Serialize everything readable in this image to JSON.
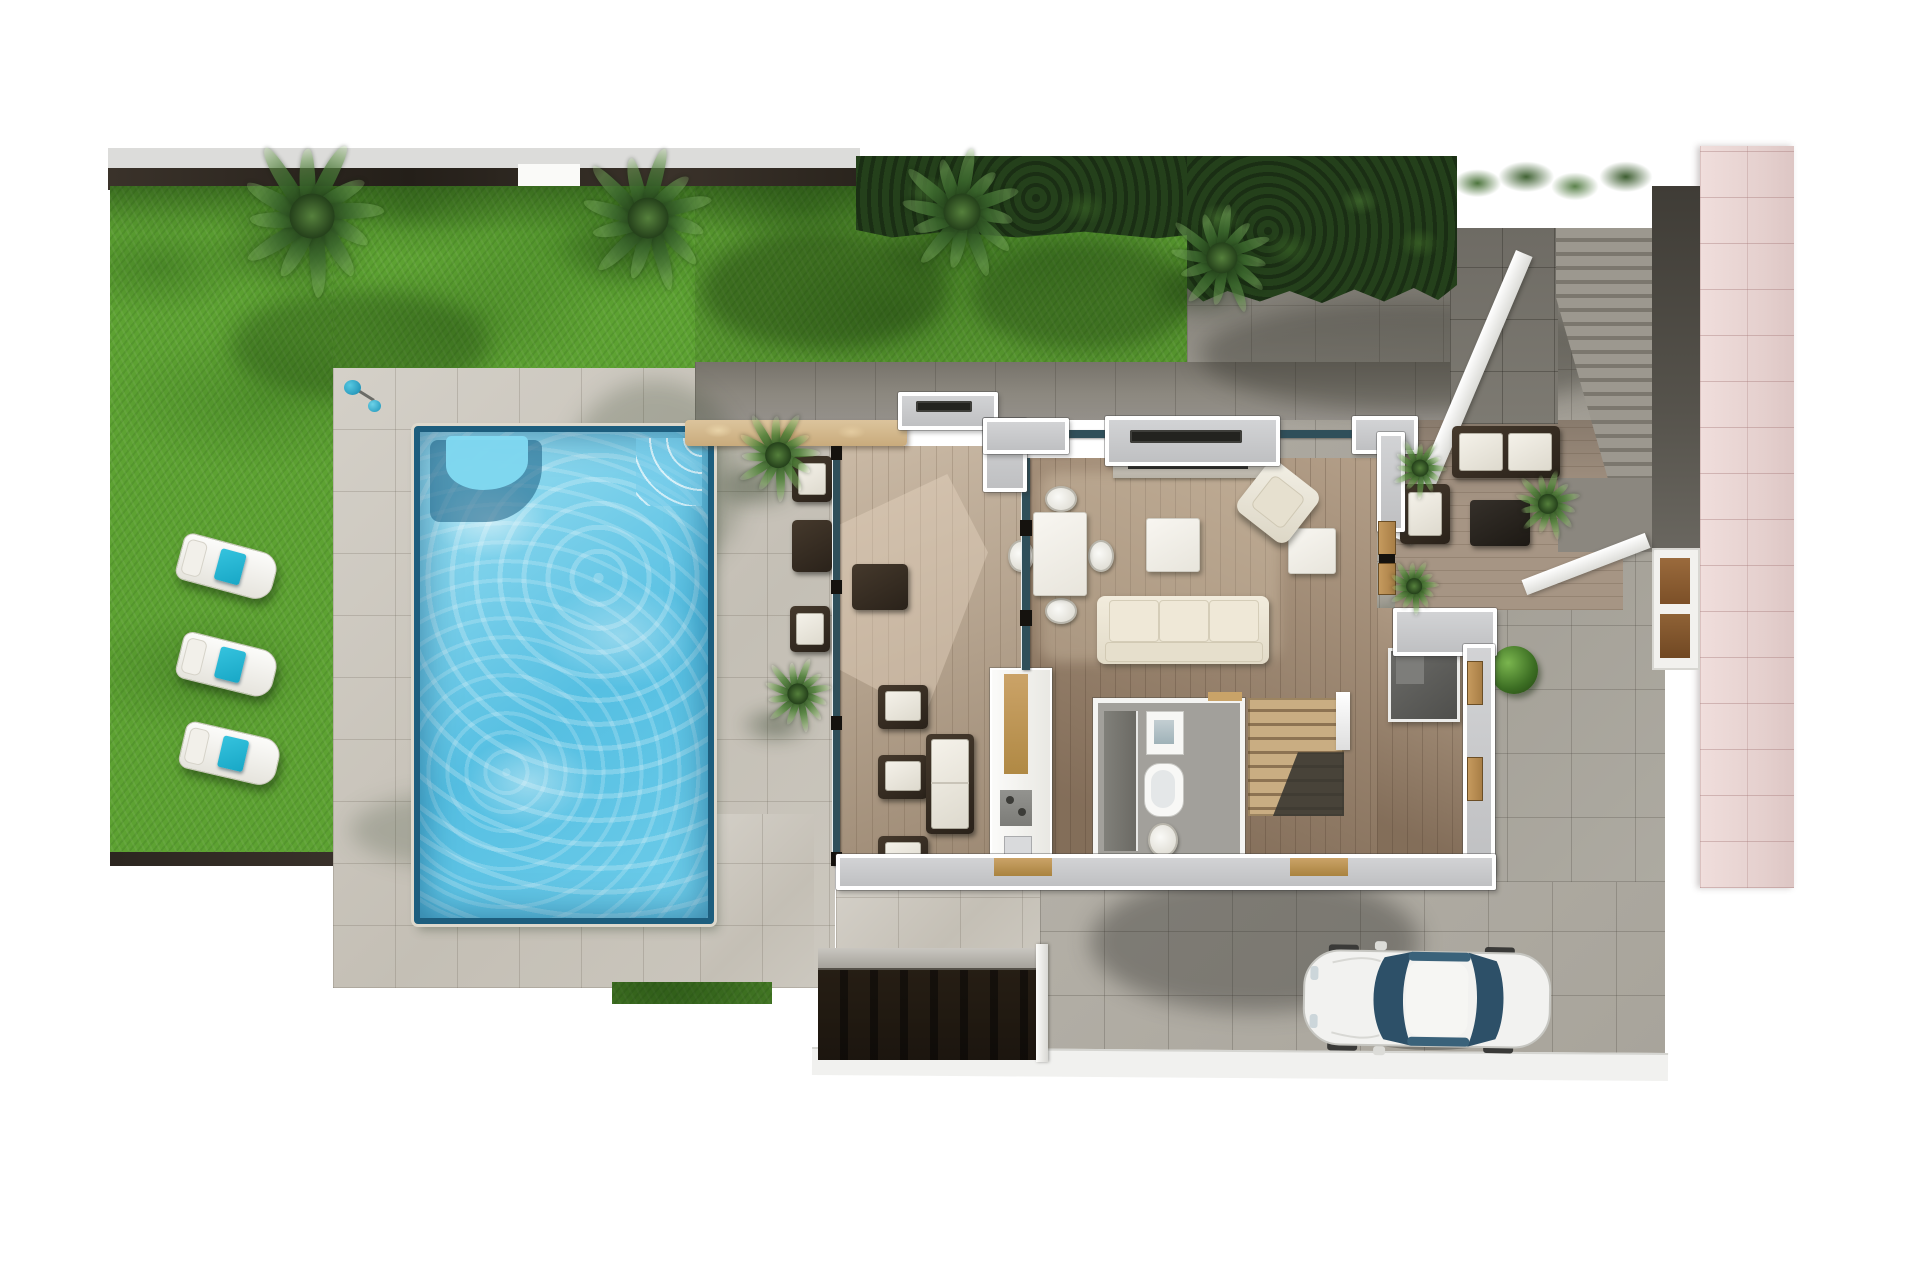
{
  "scene": {
    "title": "Villa ground-floor plan - top-down 3D render",
    "style": "photorealistic architectural visualization, no visible text"
  },
  "colors": {
    "page_bg": "#ffffff",
    "grass": "#5da232",
    "grass_shade": "#3f7d22",
    "hedge": "#24401b",
    "pool_water": "#63c8e8",
    "pool_rim": "#1d5e7e",
    "pool_bench": "#2e7da4",
    "tile_light": "#cbc6bd",
    "tile_shaded": "#8f8b82",
    "driveway": "#a8a49b",
    "deck_wood": "#b5a28c",
    "interior_wood": "#a08a73",
    "patio_wood": "#a69584",
    "wall_fill": "#c6c7c9",
    "wall_edge": "#ffffff",
    "glass": "#2f4f5a",
    "stone_bar": "#d9c29a",
    "cream_sofa": "#ece6d6",
    "dark_wicker": "#393026",
    "towel_teal": "#18a7c6",
    "sidewalk_pink": "#ead7d5",
    "ramp_dark": "#38322a",
    "stair_wood": "#c4a87e",
    "car_body": "#f2f2f0",
    "car_glass": "#2d5068",
    "bush_green": "#4e8f2e"
  },
  "rooms": {
    "lawn": {
      "label": "Garden lawn"
    },
    "pool": {
      "label": "Swimming pool"
    },
    "pool_terrace": {
      "label": "Pool terrace"
    },
    "covered_terrace": {
      "label": "Covered wooden terrace"
    },
    "living_dining": {
      "label": "Living and dining room"
    },
    "kitchen": {
      "label": "Kitchen"
    },
    "bathroom": {
      "label": "Bathroom"
    },
    "staircase": {
      "label": "Interior staircase"
    },
    "utility": {
      "label": "Utility room"
    },
    "east_patio": {
      "label": "East lounge patio"
    },
    "driveway": {
      "label": "Driveway parking"
    },
    "garage_ramp": {
      "label": "Garage ramp"
    },
    "entry_stairs": {
      "label": "External entry stairs"
    },
    "sidewalk": {
      "label": "Street sidewalk"
    },
    "street": {
      "label": "Street edge"
    }
  },
  "furniture": {
    "sun_lounger": {
      "label": "Sun lounger with towel"
    },
    "outdoor_shower": {
      "label": "Pool shower"
    },
    "stone_bar": {
      "label": "Outdoor stone bar counter"
    },
    "dining_table": {
      "label": "Dining table with four chairs"
    },
    "sofa": {
      "label": "Three-seat cream sofa"
    },
    "armchair": {
      "label": "Lounge armchair"
    },
    "coffee_table": {
      "label": "Coffee table"
    },
    "side_table": {
      "label": "Side table"
    },
    "tv_wall": {
      "label": "North window and TV wall"
    },
    "kitchen_counter": {
      "label": "Kitchen counter with sink"
    },
    "bathtub": {
      "label": "Bathtub"
    },
    "washbasin": {
      "label": "Washbasin"
    },
    "wc": {
      "label": "WC"
    },
    "utility_box": {
      "label": "Utility / shower box"
    },
    "patio_sofa": {
      "label": "Outdoor lounge sofa"
    },
    "patio_table": {
      "label": "Outdoor coffee table"
    },
    "patio_chair": {
      "label": "Outdoor armchair"
    },
    "fire_table": {
      "label": "Fire table"
    },
    "daybed": {
      "label": "Deck daybed"
    },
    "car": {
      "label": "White car parked on driveway"
    }
  },
  "landscape": {
    "palm_trees": [
      {
        "x": 312,
        "y": 216,
        "r": 80,
        "tone": 1
      },
      {
        "x": 648,
        "y": 218,
        "r": 73,
        "tone": 1
      },
      {
        "x": 962,
        "y": 212,
        "r": 66,
        "tone": 1
      },
      {
        "x": 1222,
        "y": 258,
        "r": 56,
        "tone": 1
      },
      {
        "x": 778,
        "y": 455,
        "r": 46,
        "tone": 2
      },
      {
        "x": 798,
        "y": 694,
        "r": 38,
        "tone": 2
      },
      {
        "x": 1420,
        "y": 468,
        "r": 30,
        "tone": 2
      },
      {
        "x": 1548,
        "y": 504,
        "r": 36,
        "tone": 2
      },
      {
        "x": 1414,
        "y": 586,
        "r": 28,
        "tone": 2
      }
    ],
    "sun_loungers": [
      {
        "x": 178,
        "y": 543,
        "rot": 15
      },
      {
        "x": 178,
        "y": 641,
        "rot": 14
      },
      {
        "x": 181,
        "y": 730,
        "rot": 13
      }
    ],
    "counts": {
      "palm_trees": 9,
      "sun_loungers": 3,
      "cars": 1,
      "dining_chairs": 4,
      "outdoor_chairs": 6
    }
  }
}
